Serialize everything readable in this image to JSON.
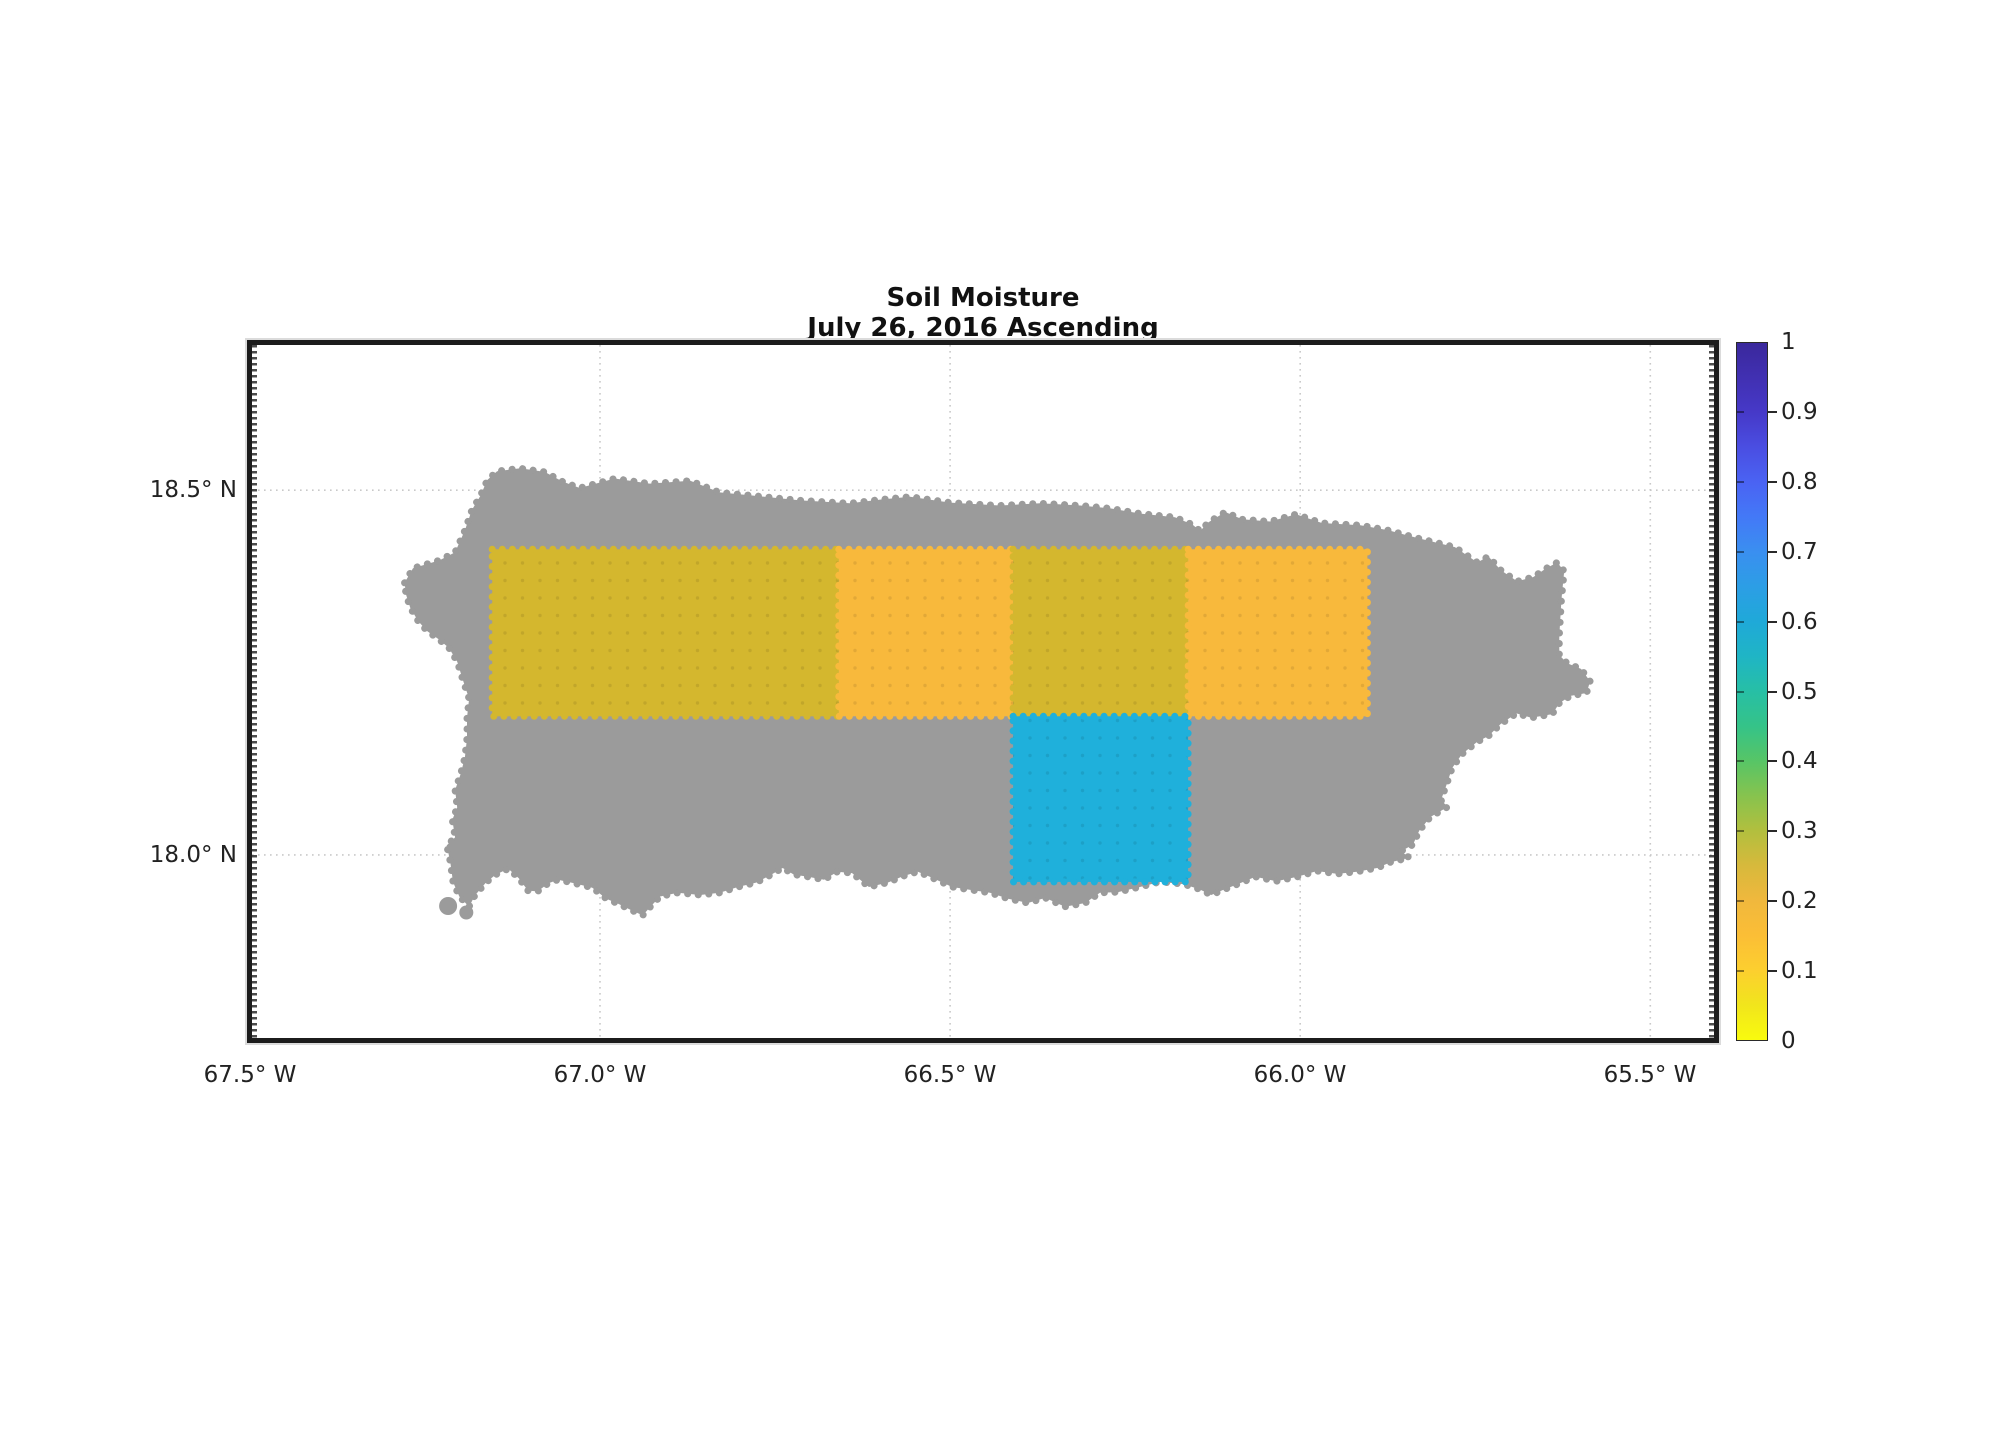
{
  "figure": {
    "title_line1": "Soil Moisture",
    "title_line2": "July 26, 2016 Ascending"
  },
  "colors": {
    "background": "#ffffff",
    "island_gray": "#9b9b9b",
    "frame": "#1c1c1c",
    "gridline": "#c9c9c9",
    "cell_olive": "#d4b72e",
    "cell_orange": "#f8b93c",
    "cell_cyan": "#1fb0db"
  },
  "chart_data": {
    "type": "heatmap",
    "title": "Soil Moisture",
    "subtitle": "July 26, 2016 Ascending",
    "region": "Puerto Rico (land mask shown in gray)",
    "grid": "dotted",
    "axes": {
      "xlim_W": [
        67.497,
        65.409
      ],
      "ylim": [
        17.749,
        18.699
      ],
      "x_ticks": [
        {
          "lon_W": 67.5,
          "label": "67.5° W"
        },
        {
          "lon_W": 67.0,
          "label": "67.0° W"
        },
        {
          "lon_W": 66.5,
          "label": "66.5° W"
        },
        {
          "lon_W": 66.0,
          "label": "66.0° W"
        },
        {
          "lon_W": 65.5,
          "label": "65.5° W"
        }
      ],
      "y_ticks": [
        {
          "lat": 18.5,
          "label": "18.5° N"
        },
        {
          "lat": 18.0,
          "label": "18.0° N"
        }
      ]
    },
    "colorbar": {
      "min": 0,
      "max": 1,
      "orientation": "vertical",
      "colormap": "parula-reversed (yellow low, indigo high)",
      "ticks": [
        {
          "value": 1.0,
          "label": "1"
        },
        {
          "value": 0.9,
          "label": "0.9"
        },
        {
          "value": 0.8,
          "label": "0.8"
        },
        {
          "value": 0.7,
          "label": "0.7"
        },
        {
          "value": 0.6,
          "label": "0.6"
        },
        {
          "value": 0.5,
          "label": "0.5"
        },
        {
          "value": 0.4,
          "label": "0.4"
        },
        {
          "value": 0.3,
          "label": "0.3"
        },
        {
          "value": 0.2,
          "label": "0.2"
        },
        {
          "value": 0.1,
          "label": "0.1"
        },
        {
          "value": 0.0,
          "label": "0"
        }
      ],
      "stops": [
        [
          0.0,
          "#f9fb0e"
        ],
        [
          0.05,
          "#f1e51c"
        ],
        [
          0.1,
          "#fccf2f"
        ],
        [
          0.15,
          "#fbbe36"
        ],
        [
          0.2,
          "#f0b83d"
        ],
        [
          0.25,
          "#d7b93c"
        ],
        [
          0.3,
          "#b2bf3e"
        ],
        [
          0.35,
          "#87c34e"
        ],
        [
          0.4,
          "#57c566"
        ],
        [
          0.45,
          "#35c388"
        ],
        [
          0.5,
          "#27bfa5"
        ],
        [
          0.55,
          "#1fb5c5"
        ],
        [
          0.6,
          "#1fa9d8"
        ],
        [
          0.65,
          "#2c9ee5"
        ],
        [
          0.7,
          "#3a8ff0"
        ],
        [
          0.75,
          "#4379f7"
        ],
        [
          0.8,
          "#4a63f3"
        ],
        [
          0.85,
          "#4a4ee2"
        ],
        [
          0.9,
          "#4639c8"
        ],
        [
          0.95,
          "#4130b2"
        ],
        [
          1.0,
          "#3a289c"
        ]
      ]
    },
    "cells": [
      {
        "id": "A",
        "lon_W": [
          67.154,
          66.659
        ],
        "lat": [
          18.19,
          18.419
        ],
        "value_est": 0.24,
        "color": "#d4b72e"
      },
      {
        "id": "B",
        "lon_W": [
          66.659,
          66.41
        ],
        "lat": [
          18.19,
          18.419
        ],
        "value_est": 0.15,
        "color": "#f8b93c"
      },
      {
        "id": "C",
        "lon_W": [
          66.41,
          66.16
        ],
        "lat": [
          18.19,
          18.419
        ],
        "value_est": 0.24,
        "color": "#d4b72e"
      },
      {
        "id": "D",
        "lon_W": [
          66.16,
          65.904
        ],
        "lat": [
          18.19,
          18.419
        ],
        "value_est": 0.15,
        "color": "#f8b93c"
      },
      {
        "id": "E",
        "lon_W": [
          66.41,
          66.16
        ],
        "lat": [
          17.963,
          18.19
        ],
        "value_est": 0.61,
        "color": "#1fb0db"
      }
    ],
    "island_outline": [
      [
        67.279,
        18.373
      ],
      [
        67.267,
        18.393
      ],
      [
        67.229,
        18.404
      ],
      [
        67.207,
        18.415
      ],
      [
        67.193,
        18.445
      ],
      [
        67.183,
        18.473
      ],
      [
        67.171,
        18.492
      ],
      [
        67.161,
        18.514
      ],
      [
        67.147,
        18.526
      ],
      [
        67.114,
        18.53
      ],
      [
        67.079,
        18.525
      ],
      [
        67.054,
        18.512
      ],
      [
        67.029,
        18.503
      ],
      [
        66.979,
        18.516
      ],
      [
        66.929,
        18.509
      ],
      [
        66.871,
        18.513
      ],
      [
        66.829,
        18.497
      ],
      [
        66.786,
        18.493
      ],
      [
        66.714,
        18.486
      ],
      [
        66.643,
        18.482
      ],
      [
        66.6,
        18.487
      ],
      [
        66.557,
        18.491
      ],
      [
        66.5,
        18.483
      ],
      [
        66.429,
        18.479
      ],
      [
        66.371,
        18.482
      ],
      [
        66.314,
        18.479
      ],
      [
        66.271,
        18.475
      ],
      [
        66.229,
        18.468
      ],
      [
        66.179,
        18.463
      ],
      [
        66.154,
        18.453
      ],
      [
        66.143,
        18.444
      ],
      [
        66.131,
        18.456
      ],
      [
        66.107,
        18.47
      ],
      [
        66.083,
        18.46
      ],
      [
        66.043,
        18.457
      ],
      [
        66.006,
        18.467
      ],
      [
        65.969,
        18.455
      ],
      [
        65.914,
        18.452
      ],
      [
        65.874,
        18.445
      ],
      [
        65.831,
        18.434
      ],
      [
        65.779,
        18.422
      ],
      [
        65.747,
        18.401
      ],
      [
        65.731,
        18.409
      ],
      [
        65.713,
        18.39
      ],
      [
        65.69,
        18.375
      ],
      [
        65.667,
        18.381
      ],
      [
        65.65,
        18.392
      ],
      [
        65.633,
        18.401
      ],
      [
        65.623,
        18.389
      ],
      [
        65.627,
        18.349
      ],
      [
        65.63,
        18.3
      ],
      [
        65.63,
        18.274
      ],
      [
        65.619,
        18.263
      ],
      [
        65.599,
        18.255
      ],
      [
        65.586,
        18.238
      ],
      [
        65.591,
        18.222
      ],
      [
        65.614,
        18.218
      ],
      [
        65.63,
        18.208
      ],
      [
        65.64,
        18.193
      ],
      [
        65.67,
        18.188
      ],
      [
        65.691,
        18.194
      ],
      [
        65.714,
        18.179
      ],
      [
        65.731,
        18.163
      ],
      [
        65.747,
        18.155
      ],
      [
        65.769,
        18.138
      ],
      [
        65.783,
        18.119
      ],
      [
        65.791,
        18.096
      ],
      [
        65.799,
        18.075
      ],
      [
        65.789,
        18.066
      ],
      [
        65.814,
        18.052
      ],
      [
        65.83,
        18.033
      ],
      [
        65.839,
        18.014
      ],
      [
        65.856,
        18.005
      ],
      [
        65.844,
        17.996
      ],
      [
        65.871,
        17.99
      ],
      [
        65.89,
        17.982
      ],
      [
        65.919,
        17.977
      ],
      [
        65.947,
        17.974
      ],
      [
        65.976,
        17.978
      ],
      [
        66.004,
        17.97
      ],
      [
        66.034,
        17.964
      ],
      [
        66.064,
        17.97
      ],
      [
        66.089,
        17.96
      ],
      [
        66.11,
        17.952
      ],
      [
        66.127,
        17.945
      ],
      [
        66.144,
        17.953
      ],
      [
        66.167,
        17.96
      ],
      [
        66.2,
        17.963
      ],
      [
        66.229,
        17.956
      ],
      [
        66.26,
        17.949
      ],
      [
        66.286,
        17.948
      ],
      [
        66.307,
        17.934
      ],
      [
        66.336,
        17.929
      ],
      [
        66.364,
        17.941
      ],
      [
        66.389,
        17.934
      ],
      [
        66.417,
        17.94
      ],
      [
        66.443,
        17.948
      ],
      [
        66.471,
        17.952
      ],
      [
        66.497,
        17.956
      ],
      [
        66.529,
        17.97
      ],
      [
        66.546,
        17.977
      ],
      [
        66.567,
        17.971
      ],
      [
        66.589,
        17.962
      ],
      [
        66.616,
        17.956
      ],
      [
        66.64,
        17.975
      ],
      [
        66.661,
        17.977
      ],
      [
        66.68,
        17.966
      ],
      [
        66.703,
        17.97
      ],
      [
        66.723,
        17.973
      ],
      [
        66.739,
        17.982
      ],
      [
        66.759,
        17.971
      ],
      [
        66.777,
        17.962
      ],
      [
        66.803,
        17.956
      ],
      [
        66.829,
        17.948
      ],
      [
        66.857,
        17.945
      ],
      [
        66.889,
        17.948
      ],
      [
        66.914,
        17.943
      ],
      [
        66.927,
        17.93
      ],
      [
        66.939,
        17.917
      ],
      [
        66.957,
        17.925
      ],
      [
        66.974,
        17.933
      ],
      [
        66.991,
        17.94
      ],
      [
        67.011,
        17.955
      ],
      [
        67.036,
        17.961
      ],
      [
        67.06,
        17.966
      ],
      [
        67.074,
        17.961
      ],
      [
        67.089,
        17.95
      ],
      [
        67.103,
        17.951
      ],
      [
        67.116,
        17.968
      ],
      [
        67.131,
        17.981
      ],
      [
        67.149,
        17.973
      ],
      [
        67.163,
        17.962
      ],
      [
        67.179,
        17.944
      ],
      [
        67.187,
        17.929
      ],
      [
        67.201,
        17.943
      ],
      [
        67.21,
        17.963
      ],
      [
        67.214,
        17.991
      ],
      [
        67.219,
        18.013
      ],
      [
        67.207,
        18.024
      ],
      [
        67.211,
        18.048
      ],
      [
        67.204,
        18.065
      ],
      [
        67.207,
        18.089
      ],
      [
        67.199,
        18.111
      ],
      [
        67.193,
        18.134
      ],
      [
        67.19,
        18.16
      ],
      [
        67.19,
        18.188
      ],
      [
        67.187,
        18.214
      ],
      [
        67.196,
        18.24
      ],
      [
        67.204,
        18.265
      ],
      [
        67.216,
        18.284
      ],
      [
        67.231,
        18.296
      ],
      [
        67.247,
        18.307
      ],
      [
        67.26,
        18.321
      ],
      [
        67.271,
        18.339
      ],
      [
        67.277,
        18.357
      ]
    ],
    "islets": [
      {
        "lon_W": 67.217,
        "lat": 17.93,
        "r_px": 9
      },
      {
        "lon_W": 67.191,
        "lat": 17.921,
        "r_px": 7
      }
    ]
  }
}
